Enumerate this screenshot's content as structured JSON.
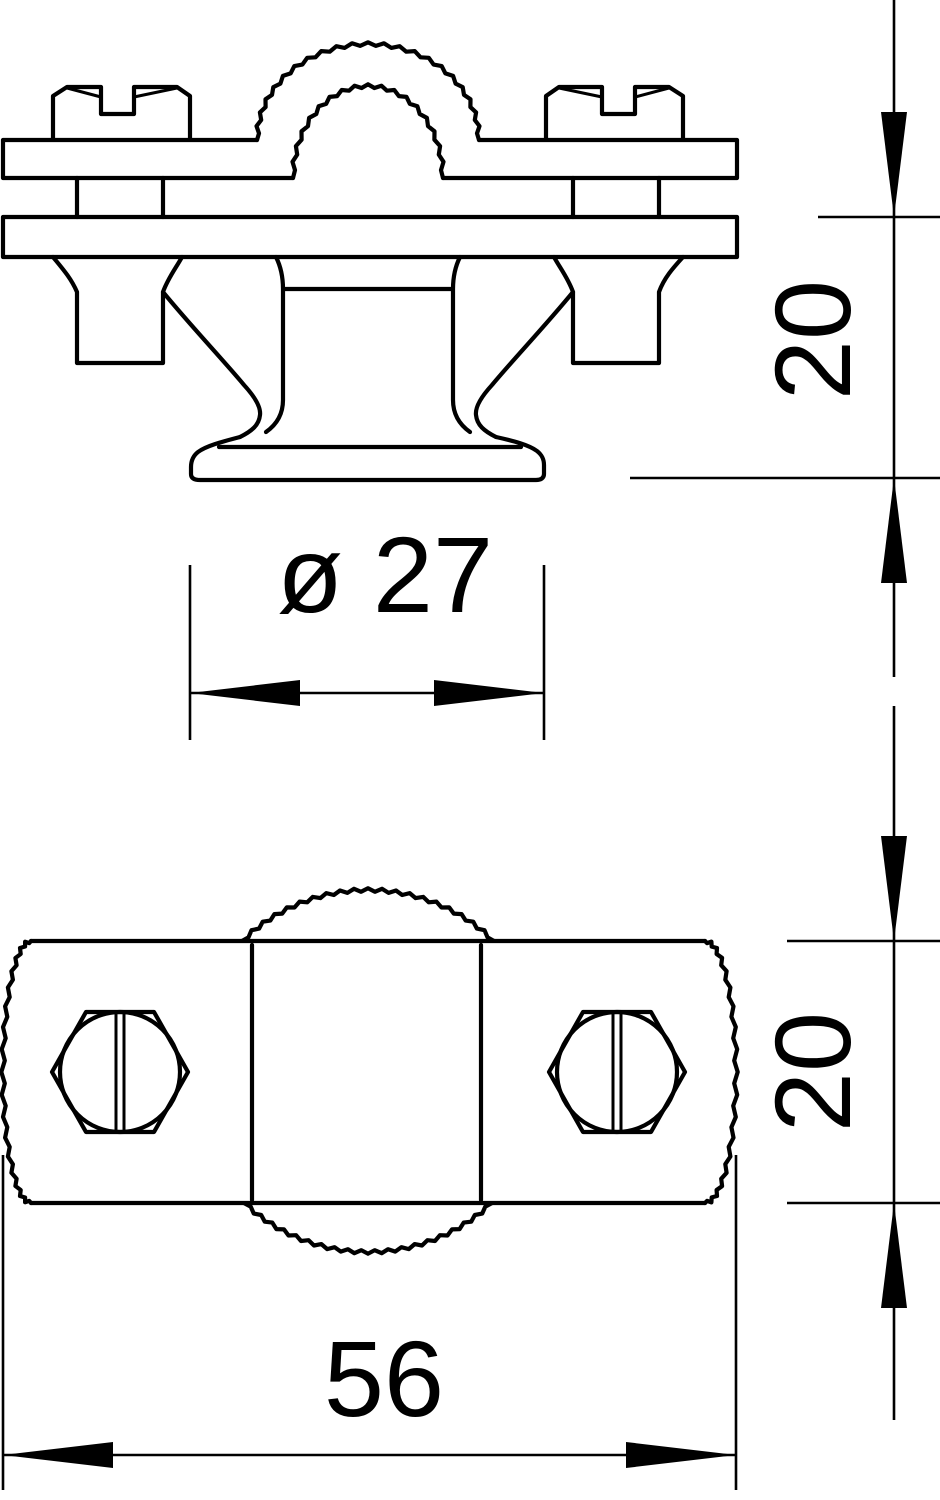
{
  "page": {
    "background_color": "#ffffff",
    "line_color": "#000000"
  },
  "drawing": {
    "dimensions": {
      "side_height": {
        "label": "20",
        "orientation": "vertical"
      },
      "foot_diameter": {
        "label": "ø 27",
        "orientation": "horizontal"
      },
      "plan_height": {
        "label": "20",
        "orientation": "vertical"
      },
      "plan_width": {
        "label": "56",
        "orientation": "horizontal"
      }
    }
  }
}
